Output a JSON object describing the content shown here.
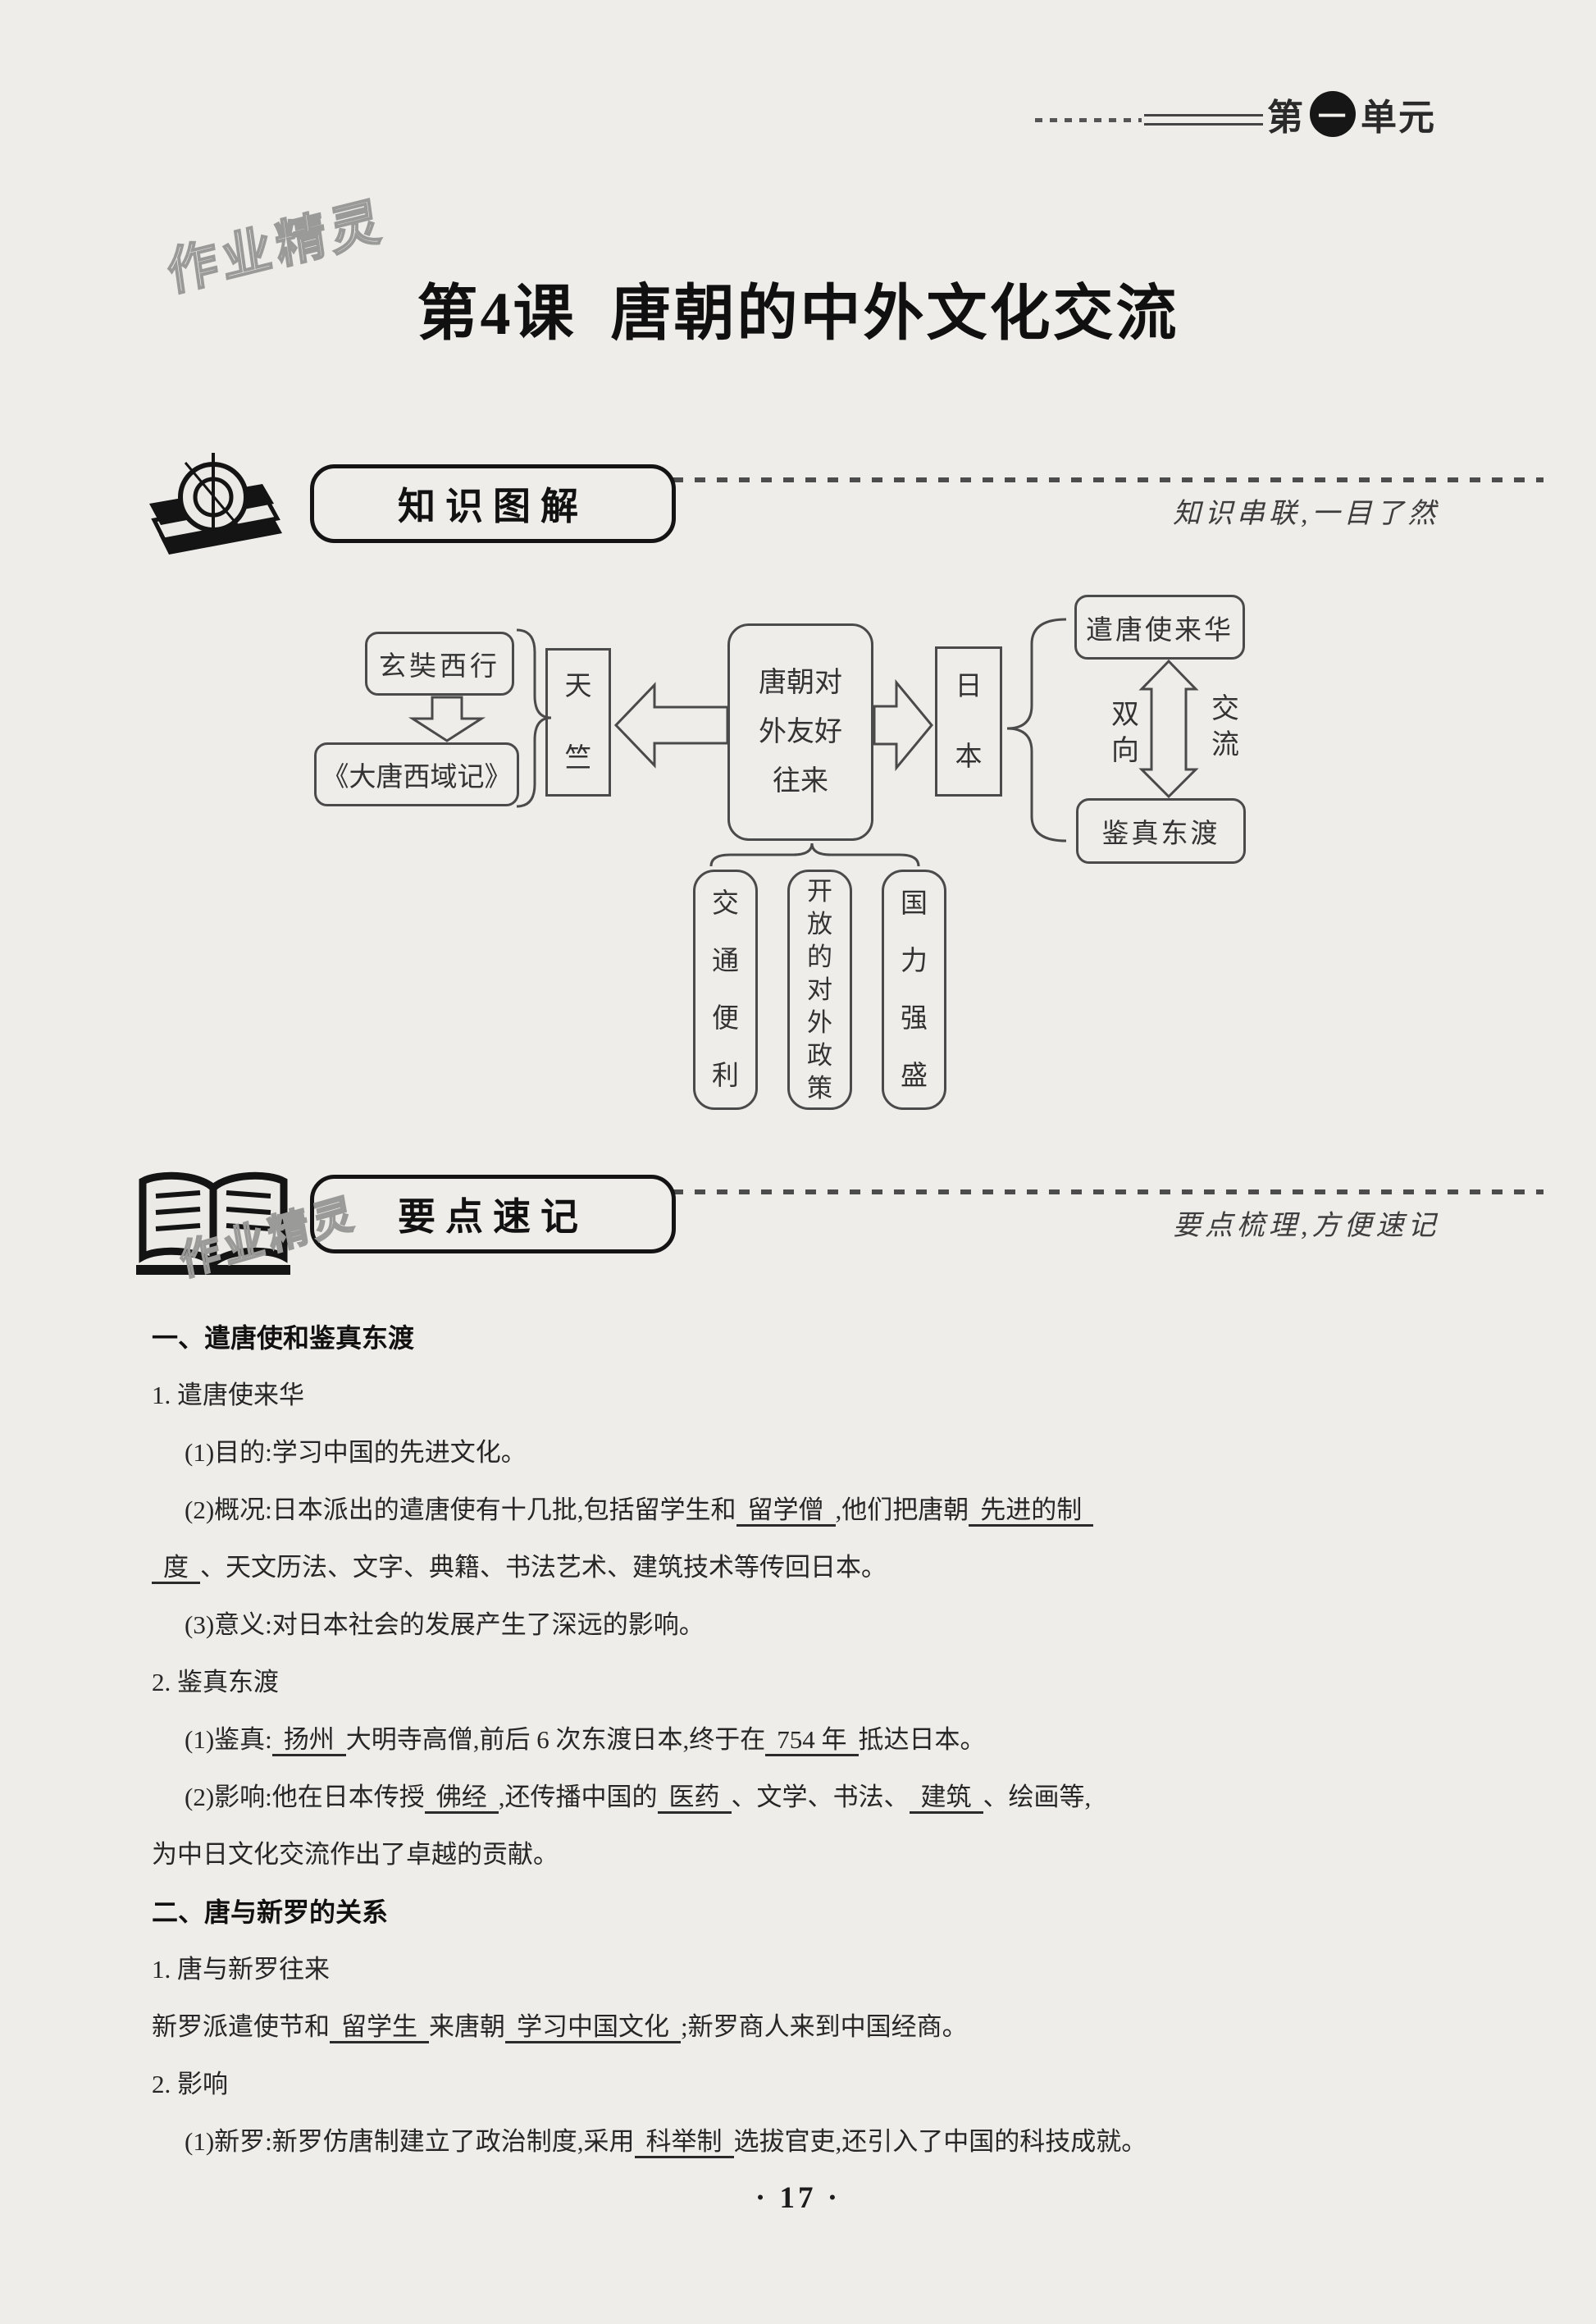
{
  "header": {
    "unit_prefix": "第",
    "unit_number": "一",
    "unit_suffix": "单元"
  },
  "title": {
    "lesson": "第4课",
    "name": "唐朝的中外文化交流"
  },
  "watermarks": {
    "top": "作业精灵",
    "middle": "作业精灵"
  },
  "sections": {
    "diagram": {
      "badge": "知识图解",
      "tagline": "知识串联,一目了然"
    },
    "notes": {
      "badge": "要点速记",
      "tagline": "要点梳理,方便速记"
    }
  },
  "diagram": {
    "xuanzang_box": "玄奘西行",
    "datang_box": "《大唐西域记》",
    "tianzhu_box": "天竺",
    "center_box": "唐朝对外友好往来",
    "japan_box": "日本",
    "envoys_box": "遣唐使来华",
    "jianzhen_box": "鉴真东渡",
    "arrow_label_left": "双向",
    "arrow_label_right": "交流",
    "bottom_boxes": [
      "交通便利",
      "开放的对外政策",
      "国力强盛"
    ]
  },
  "notes": {
    "lines": [
      {
        "bold": true,
        "indent": 0,
        "segments": [
          {
            "t": "一、遣唐使和鉴真东渡"
          }
        ]
      },
      {
        "indent": 0,
        "segments": [
          {
            "t": "1. 遣唐使来华"
          }
        ]
      },
      {
        "indent": 1,
        "segments": [
          {
            "t": "(1)目的:学习中国的先进文化。"
          }
        ]
      },
      {
        "indent": 1,
        "segments": [
          {
            "t": "(2)概况:日本派出的遣唐使有十几批,包括留学生和"
          },
          {
            "u": "留学僧"
          },
          {
            "t": ",他们把唐朝"
          },
          {
            "u": "先进的制"
          }
        ]
      },
      {
        "indent": 0,
        "segments": [
          {
            "u": "度"
          },
          {
            "t": "、天文历法、文字、典籍、书法艺术、建筑技术等传回日本。"
          }
        ]
      },
      {
        "indent": 1,
        "segments": [
          {
            "t": "(3)意义:对日本社会的发展产生了深远的影响。"
          }
        ]
      },
      {
        "indent": 0,
        "segments": [
          {
            "t": "2. 鉴真东渡"
          }
        ]
      },
      {
        "indent": 1,
        "segments": [
          {
            "t": "(1)鉴真:"
          },
          {
            "u": "扬州"
          },
          {
            "t": "大明寺高僧,前后 6 次东渡日本,终于在"
          },
          {
            "u": "754 年"
          },
          {
            "t": "抵达日本。"
          }
        ]
      },
      {
        "indent": 1,
        "segments": [
          {
            "t": "(2)影响:他在日本传授"
          },
          {
            "u": "佛经"
          },
          {
            "t": ",还传播中国的"
          },
          {
            "u": "医药"
          },
          {
            "t": "、文学、书法、"
          },
          {
            "u": "建筑"
          },
          {
            "t": "、绘画等,"
          }
        ]
      },
      {
        "indent": 0,
        "segments": [
          {
            "t": "为中日文化交流作出了卓越的贡献。"
          }
        ]
      },
      {
        "bold": true,
        "indent": 0,
        "segments": [
          {
            "t": "二、唐与新罗的关系"
          }
        ]
      },
      {
        "indent": 0,
        "segments": [
          {
            "t": "1. 唐与新罗往来"
          }
        ]
      },
      {
        "indent": 0,
        "segments": [
          {
            "t": "新罗派遣使节和"
          },
          {
            "u": "留学生"
          },
          {
            "t": "来唐朝"
          },
          {
            "u": "学习中国文化"
          },
          {
            "t": ";新罗商人来到中国经商。"
          }
        ]
      },
      {
        "indent": 0,
        "segments": [
          {
            "t": "2. 影响"
          }
        ]
      },
      {
        "indent": 1,
        "segments": [
          {
            "t": "(1)新罗:新罗仿唐制建立了政治制度,采用"
          },
          {
            "u": "科举制"
          },
          {
            "t": "选拔官吏,还引入了中国的科技成就。"
          }
        ]
      }
    ]
  },
  "footer": {
    "page_number": "· 17 ·"
  }
}
